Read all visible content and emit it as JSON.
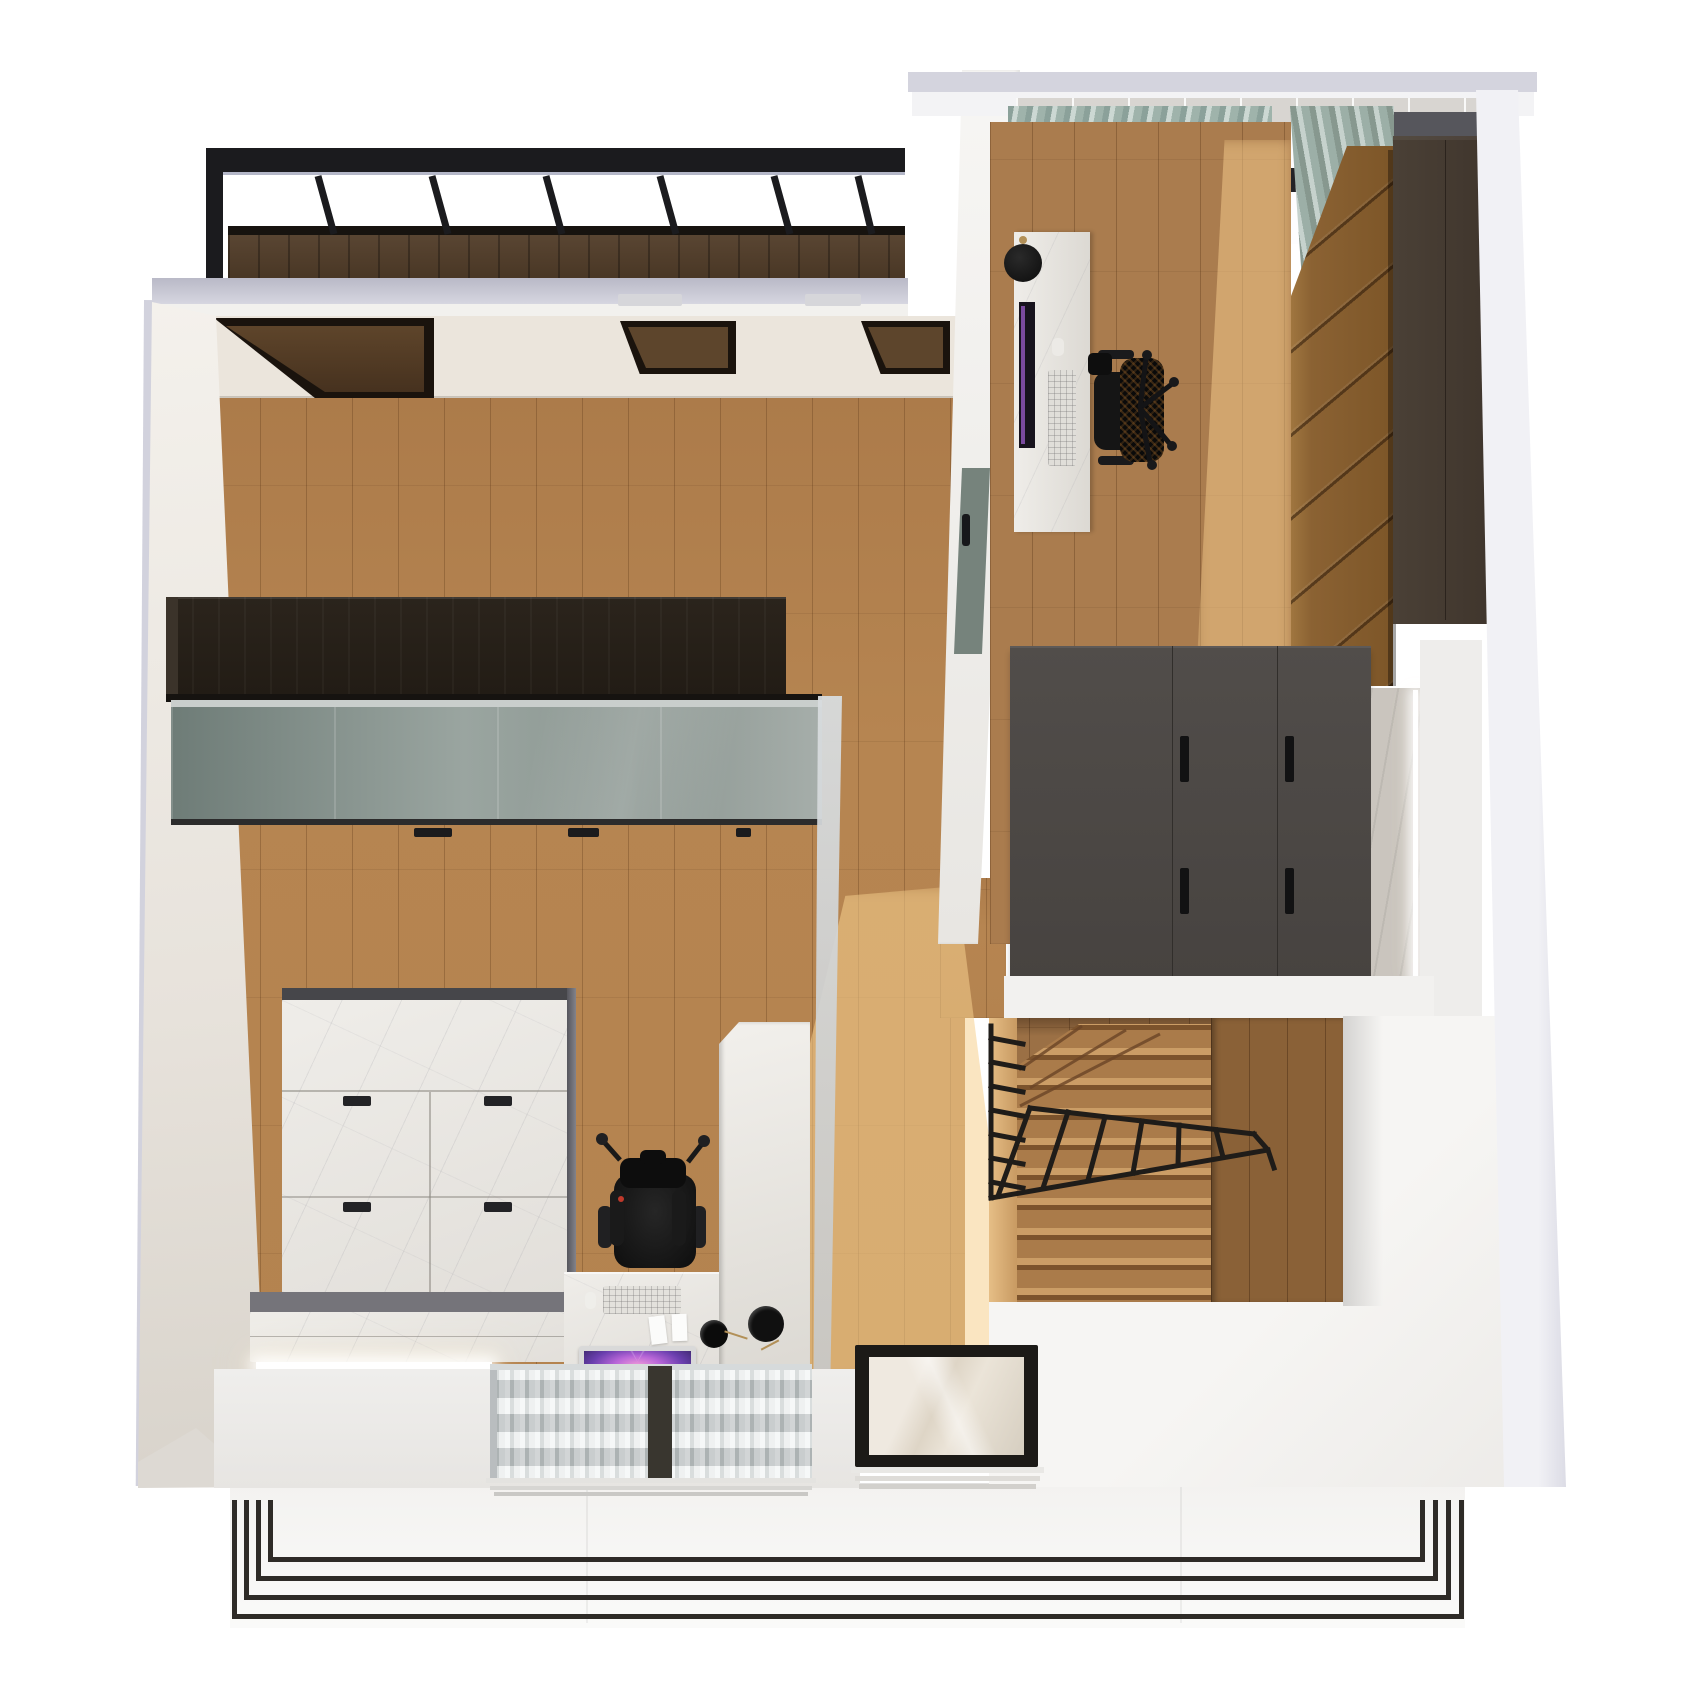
{
  "scene": {
    "kind": "3d-architectural-render",
    "view": "top-down dollhouse view of an apartment level",
    "canvas": {
      "width": 1703,
      "height": 1704
    },
    "background": "#ffffff",
    "text_visible": "none"
  },
  "palette": {
    "outer_wall_grey": "#d3d3de",
    "inner_wall_white": "#f3f2ef",
    "ceiling_warm_white": "#ebe5dc",
    "floor_oak": "#b4834f",
    "floor_oak_right": "#aa7c4e",
    "stair_wall_wood": "#9b7045",
    "pergola_wood_dark": "#4e3b2b",
    "metal_black": "#1c1a18",
    "wardrobe_black_brown": "#262019",
    "wardrobe_glass_green": "#8b9792",
    "marble_white": "#e9e7e2",
    "bench_grey": "#757378",
    "chair_black": "#141414",
    "monitor_screen_purple": "#8b4fd0",
    "curtain_sage": "#9caba5",
    "curtain_sheer_white": "#e8ebeb",
    "walnut_wardrobe": "#8b6233",
    "tall_cabinet_brown": "#453b32",
    "dresser_grey": "#4d4946",
    "stair_tread_oak": "#c99b64",
    "terrace_white": "#f8f7f6",
    "led_strip": "#ffffff",
    "door_sage": "#76837c"
  },
  "rooms": [
    {
      "id": "living-room",
      "label": "Living room with black wardrobe, glass sliding front, marble cabinet and vanity desk nook"
    },
    {
      "id": "corridor",
      "label": "Corridor with sunlit oak floor leading to stairwell"
    },
    {
      "id": "bedroom-office",
      "label": "Bedroom office with marble desk, mesh chair, walnut wardrobe and grey dresser"
    },
    {
      "id": "stairwell",
      "label": "Winder staircase with oak treads and black rod railing"
    },
    {
      "id": "landing",
      "label": "White landing beside the stairwell"
    },
    {
      "id": "terrace",
      "label": "White terrace with thin black perimeter railing"
    }
  ],
  "architecture": [
    {
      "id": "pergola",
      "label": "Black steel pergola frame with cross bars over dark wood parapet"
    },
    {
      "id": "skylights",
      "label": "Three dark-framed ceiling skylight openings",
      "count": 3
    },
    {
      "id": "separating-wall",
      "label": "Wall between living room and bedroom with sage door"
    },
    {
      "id": "glass-floor-panel",
      "label": "Black framed glass floor panel in terrace"
    },
    {
      "id": "glass-partition",
      "label": "Tall glass partition screen beside vanity desk"
    },
    {
      "id": "balcony-railing",
      "label": "Nested thin black balcony railing, bottom edge"
    },
    {
      "id": "stair-railing",
      "label": "Thin black rod stair railing with balusters"
    },
    {
      "id": "led-strips",
      "label": "Warm white LED light strips under bench and beside dresser column",
      "count": 2
    }
  ],
  "furniture": [
    {
      "id": "black-wardrobe",
      "room": "living-room",
      "color": "#262019"
    },
    {
      "id": "glass-sliding-front",
      "room": "living-room",
      "color": "#8b9792",
      "handles": 3
    },
    {
      "id": "marble-cabinet",
      "room": "living-room",
      "color": "#e9e7e2",
      "handles": 4
    },
    {
      "id": "marble-bench",
      "room": "living-room",
      "color": "#e8e6e1"
    },
    {
      "id": "vanity-desk",
      "room": "living-room",
      "color": "#ebe9e4"
    },
    {
      "id": "gaming-chair",
      "room": "living-room",
      "color": "#141414"
    },
    {
      "id": "widescreen-monitor",
      "room": "living-room",
      "screen": "#8b4fd0"
    },
    {
      "id": "keyboard",
      "room": "living-room",
      "color": "#e3e1dc"
    },
    {
      "id": "disc-wall-lamps",
      "room": "living-room",
      "count": 2,
      "color": "#0e0e0e"
    },
    {
      "id": "sheer-curtains",
      "room": "living-room",
      "sections": 2,
      "color": "#e8ebeb"
    },
    {
      "id": "marble-desk",
      "room": "bedroom-office",
      "color": "#efede9"
    },
    {
      "id": "office-chair",
      "room": "bedroom-office",
      "color": "#141414"
    },
    {
      "id": "desk-monitor",
      "room": "bedroom-office",
      "color": "#17131d"
    },
    {
      "id": "desk-keyboard",
      "room": "bedroom-office",
      "color": "#e0ded9"
    },
    {
      "id": "pendant-lamp",
      "room": "bedroom-office",
      "color": "#0c0c0c"
    },
    {
      "id": "sage-curtains",
      "room": "bedroom-office",
      "sections": 2,
      "color": "#9caba5"
    },
    {
      "id": "walnut-wardrobe",
      "room": "bedroom-office",
      "color": "#8b6233"
    },
    {
      "id": "tall-brown-cabinet",
      "room": "bedroom-office",
      "color": "#453b32"
    },
    {
      "id": "grey-dresser",
      "room": "bedroom-office",
      "color": "#4d4946",
      "handles": 4
    }
  ]
}
